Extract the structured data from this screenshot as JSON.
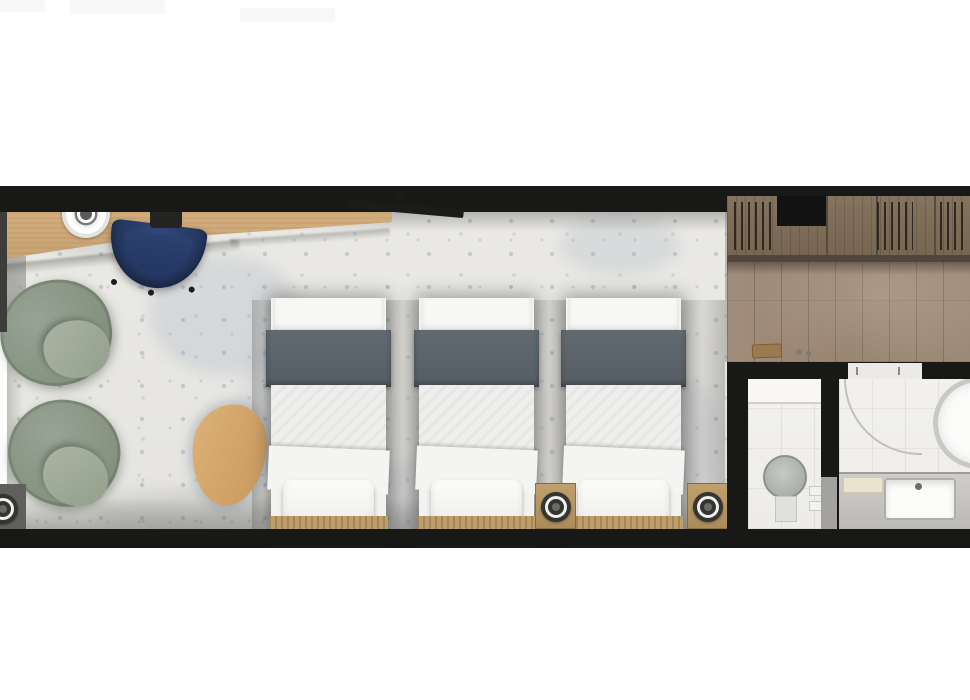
{
  "title": "Hotel suite floor plan — triple room with bathroom",
  "scene": {
    "type": "floor-plan",
    "view": "top-down",
    "text_visible": false
  },
  "colors": {
    "wall": "#181817",
    "terrazzo": "#e9e8e4",
    "wood-floor": "#9b8775",
    "wardrobe-wood": "#7e6d5b",
    "desk-wood": "#cdaa7b",
    "chair-navy": "#26395f",
    "armchair-sage": "#8b9889",
    "bed-runner-gray": "#5c656c",
    "linen-white": "#f4f4f2",
    "tile-white": "#f1f0ed",
    "nightstand-tan": "#b79560",
    "counter-gray": "#c6c4c0"
  },
  "rooms": [
    {
      "name": "bedroom",
      "floor": "terrazzo tile"
    },
    {
      "name": "dressing-corridor",
      "floor": "wood planks",
      "features": [
        "built-in wardrobe with hangers",
        "recessed niche"
      ]
    },
    {
      "name": "wc",
      "floor": "white tile",
      "fixtures": [
        "round toilet",
        "flush buttons",
        "door"
      ]
    },
    {
      "name": "bathroom",
      "floor": "white tile",
      "fixtures": [
        "vanity with sink and faucet",
        "round tub (cropped at edge)",
        "door swing arc",
        "bath mat"
      ]
    }
  ],
  "furniture": [
    {
      "name": "desk",
      "room": "bedroom",
      "material": "wood"
    },
    {
      "name": "desk-chair",
      "room": "bedroom",
      "color": "navy-blue"
    },
    {
      "name": "wall-mounted-tv",
      "room": "bedroom"
    },
    {
      "name": "decorative-plate",
      "room": "bedroom"
    },
    {
      "name": "tablet",
      "room": "bedroom"
    },
    {
      "name": "armchair",
      "room": "bedroom",
      "count": 2,
      "color": "sage-green"
    },
    {
      "name": "side-table",
      "room": "bedroom",
      "shape": "rounded-triangle",
      "material": "wood"
    },
    {
      "name": "single-bed",
      "room": "bedroom",
      "count": 3,
      "bedding": "white linen with gray runner"
    },
    {
      "name": "nightstand-with-lamp",
      "room": "bedroom",
      "count": 3
    },
    {
      "name": "luggage-tray",
      "room": "dressing-corridor"
    }
  ]
}
